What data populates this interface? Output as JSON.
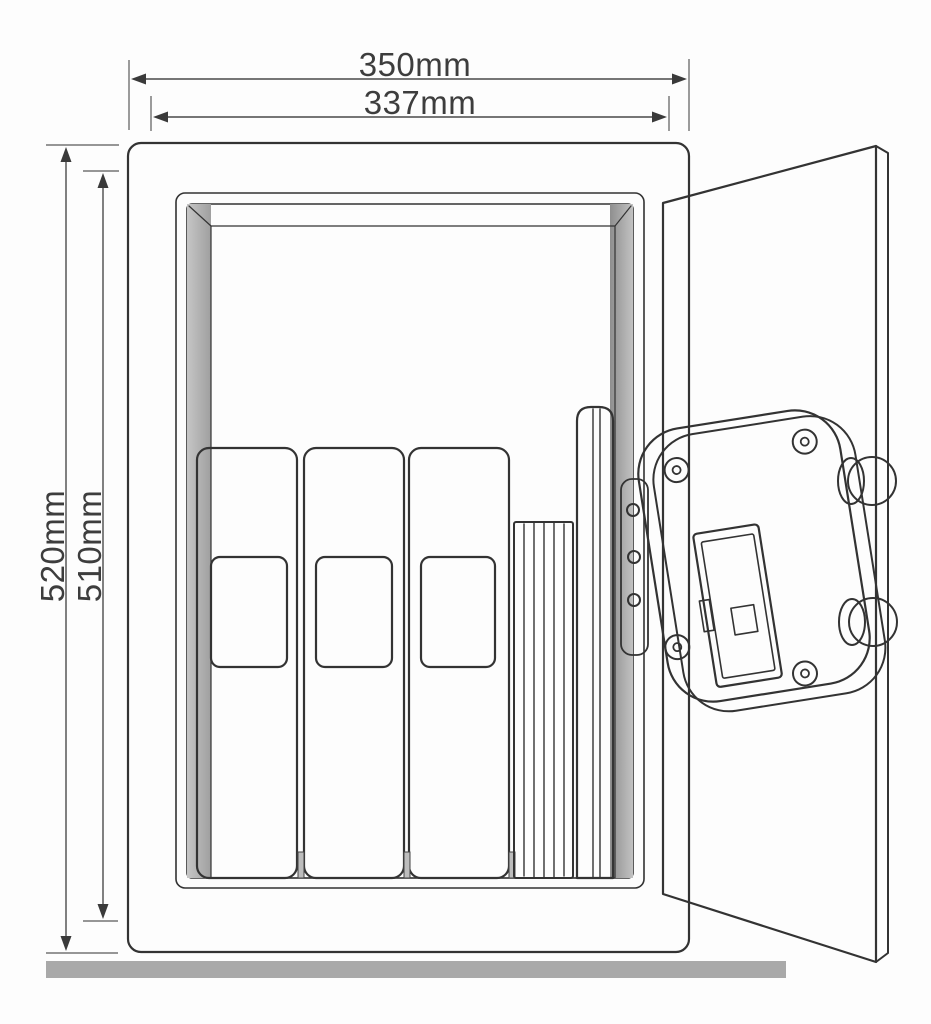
{
  "diagram": {
    "type": "technical-dimension-drawing",
    "subject": "open safe with door, binders and documents inside",
    "dimensions": {
      "outer_width_label": "350mm",
      "inner_width_label": "337mm",
      "outer_height_label": "520mm",
      "inner_height_label": "510mm"
    },
    "colors": {
      "outline": "#333333",
      "safe_body": "#f6f6f6",
      "inner_frame": "#e7e7e7",
      "interior_wall": "#b8b8b8",
      "interior_back": "#9e9e9e",
      "binder_tan": "#cdbb9d",
      "binder_label": "#ffffff",
      "document_stack": "#ffffff",
      "folder_gray": "#d6d6d6",
      "door_panel": "#d9d9d9",
      "door_edge": "#ececec",
      "lock_housing": "#f8f8f8",
      "bolt_gray": "#d2d2d2",
      "floor": "#a9a9a9"
    }
  }
}
